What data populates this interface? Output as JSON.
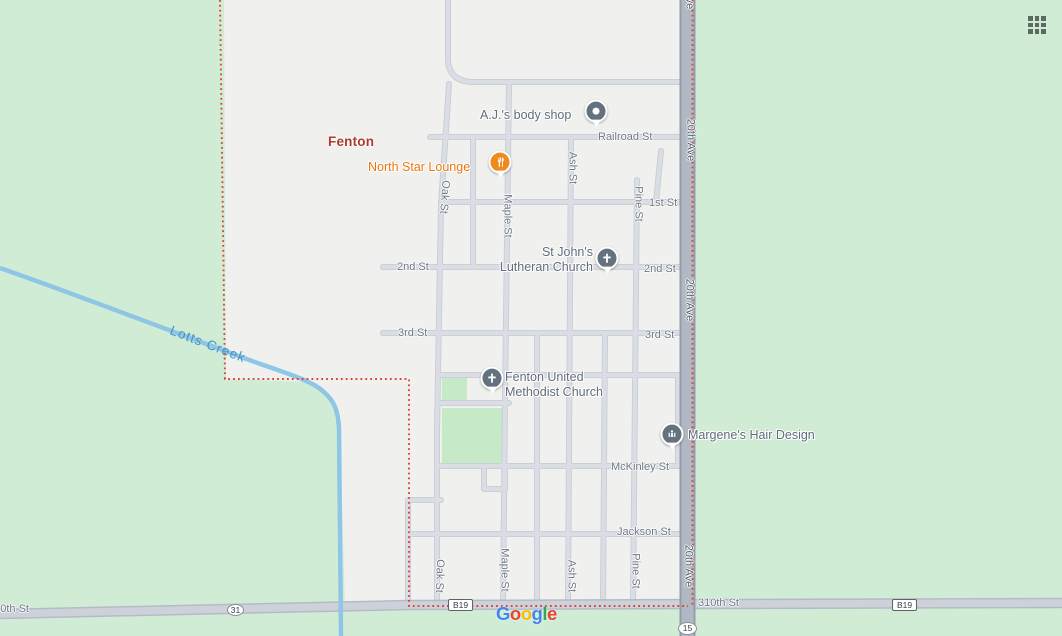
{
  "region": {
    "town_label": "Fenton",
    "creek_label": "Lotts Creek"
  },
  "street_labels": [
    {
      "text": "Railroad St"
    },
    {
      "text": "1st St"
    },
    {
      "text": "2nd St"
    },
    {
      "text": "2nd St"
    },
    {
      "text": "3rd St"
    },
    {
      "text": "3rd St"
    },
    {
      "text": "McKinley St"
    },
    {
      "text": "Jackson St"
    },
    {
      "text": "310th St"
    },
    {
      "text": "310th St"
    },
    {
      "text": "Oak St"
    },
    {
      "text": "Maple St"
    },
    {
      "text": "Ash St"
    },
    {
      "text": "Pine St"
    },
    {
      "text": "Oak St"
    },
    {
      "text": "Maple St"
    },
    {
      "text": "Ash St"
    },
    {
      "text": "Pine St"
    },
    {
      "text": "20th Ave"
    },
    {
      "text": "20th Ave"
    },
    {
      "text": "20th Ave"
    },
    {
      "text": "20th Ave"
    }
  ],
  "pois": [
    {
      "name": "A.J.'s body shop",
      "icon": "poi-dot-icon"
    },
    {
      "name": "North Star Lounge",
      "icon": "restaurant-icon"
    },
    {
      "name": "St John's Lutheran Church",
      "line1": "St John's",
      "line2": "Lutheran Church",
      "icon": "church-icon"
    },
    {
      "name": "Fenton United Methodist Church",
      "line1": "Fenton United",
      "line2": "Methodist Church",
      "icon": "church-icon"
    },
    {
      "name": "Margene's Hair Design",
      "icon": "beauty-salon-icon"
    }
  ],
  "route_badges": [
    {
      "label": "31",
      "shape": "ellipse"
    },
    {
      "label": "B19",
      "shape": "rect"
    },
    {
      "label": "B19",
      "shape": "rect"
    },
    {
      "label": "15",
      "shape": "ellipse"
    }
  ],
  "logo": {
    "text": "Google",
    "letters": [
      {
        "ch": "G",
        "color": "#4285F4"
      },
      {
        "ch": "o",
        "color": "#EA4335"
      },
      {
        "ch": "o",
        "color": "#FBBC05"
      },
      {
        "ch": "g",
        "color": "#4285F4"
      },
      {
        "ch": "l",
        "color": "#34A853"
      },
      {
        "ch": "e",
        "color": "#EA4335"
      }
    ]
  },
  "icons": {
    "apps_grid": "apps-grid-icon",
    "poi_dot": "poi-dot-icon",
    "restaurant": "restaurant-icon",
    "church": "church-icon",
    "beauty_salon": "beauty-salon-icon"
  },
  "colors": {
    "land": "#d1ecd5",
    "urban": "#f0f0ee",
    "park": "#c6e9c7",
    "water": "#8fc6e6",
    "road_minor": "#dadde3",
    "road_minor_casing": "#c8cdd6",
    "road_310th": "#cdd2da",
    "road_20th_ave": "#b1b8c3",
    "boundary": "#dc4437",
    "town_label": "#a93c30",
    "street_label": "#6d7685",
    "poi_label": "#5f6c7b",
    "poi_orange": "#e8770e",
    "water_label": "#4595c5",
    "pin_slate": "#64717e",
    "pin_orange": "#ef8a1f"
  }
}
